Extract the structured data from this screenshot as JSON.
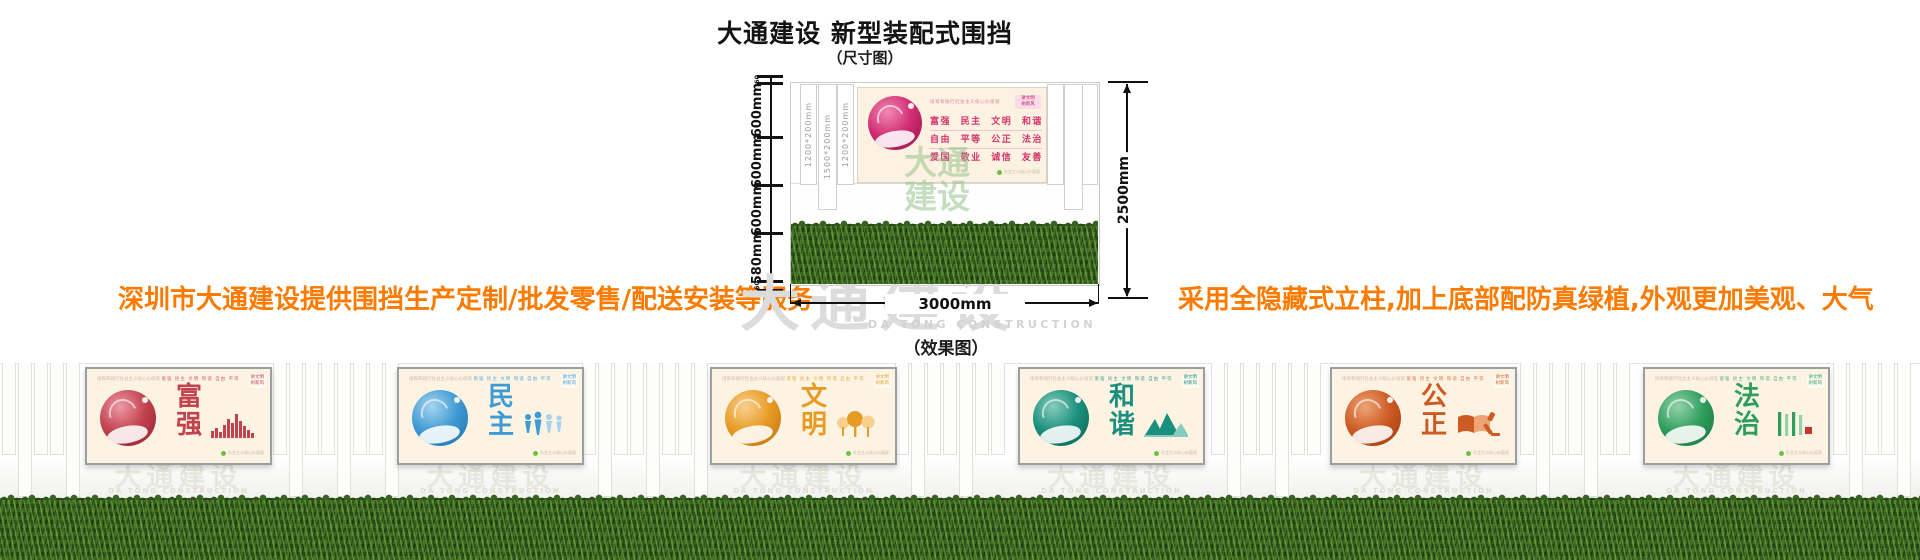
{
  "header": {
    "title": "大通建设 新型装配式围挡",
    "subtitle": "（尺寸图）"
  },
  "captions": {
    "effect": "（效果图）"
  },
  "notes": {
    "left": "深圳市大通建设提供围挡生产定制/批发零售/配送安装等服务",
    "right": "采用全隐藏式立柱,加上底部配防真绿植,外观更加美观、大气",
    "color": "#fb7a00"
  },
  "watermark": {
    "cjk": "大通建设",
    "latin": "DA TONG CONSTRUCTION"
  },
  "diagram": {
    "total_height_label": "2500mm",
    "total_width_label": "3000mm",
    "ruler_segments": [
      "60",
      "600mm",
      "600mm",
      "600mm",
      "580mm",
      "60"
    ],
    "post_labels": [
      "1200*200mm",
      "1500*200mm",
      "1200*200mm"
    ],
    "poster": {
      "slogan_header": "培育和践行社会主义核心价值观",
      "corner_badge": [
        "讲文明",
        "树新风"
      ],
      "value_rows": [
        "富强 民主 文明 和谐",
        "自由 平等 公正 法治",
        "爱国 敬业 诚信 友善"
      ],
      "values_inline": "富强 民主 文明 和谐 自由 平等 公正 法治 爱国 敬业 诚信 友善",
      "footer_note": "社会主义核心价值观",
      "accent_color": "#d6336c"
    }
  },
  "effect_panels": [
    {
      "word": "富强",
      "color": "#c2424e",
      "light": "#ed9aa6",
      "dark": "#8f1d33",
      "icon": "city-bars-icon"
    },
    {
      "word": "民主",
      "color": "#3e9bd3",
      "light": "#a6d4ee",
      "dark": "#1b6ca8",
      "icon": "people-icon"
    },
    {
      "word": "文明",
      "color": "#e89b24",
      "light": "#f7cf8e",
      "dark": "#b96e10",
      "icon": "trees-icon"
    },
    {
      "word": "和谐",
      "color": "#1b8f7d",
      "light": "#86cbbb",
      "dark": "#0b5e50",
      "icon": "mountains-icon"
    },
    {
      "word": "公正",
      "color": "#cd5a22",
      "light": "#eda477",
      "dark": "#973a0d",
      "icon": "book-gavel-icon"
    },
    {
      "word": "法治",
      "color": "#2f9e5c",
      "light": "#94d2ab",
      "dark": "#1b6e3e",
      "icon": "calligraphy-icon"
    }
  ]
}
